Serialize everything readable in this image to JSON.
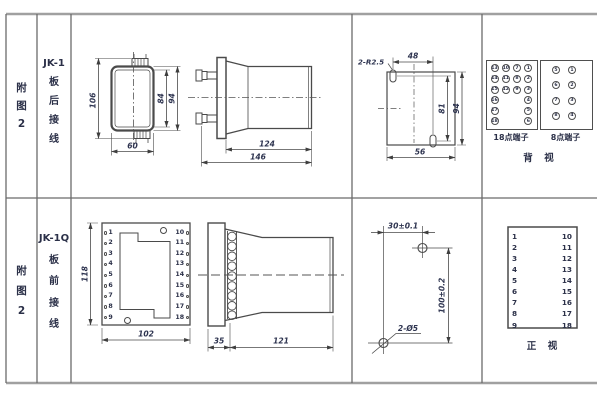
{
  "colors": {
    "frame_outer": "#a0a0a0",
    "grid_line": "#6b6b6b",
    "draw_line": "#4a4a4a",
    "text": "#2e3450"
  },
  "rows": [
    {
      "fig": [
        "附",
        "图",
        "2"
      ],
      "model": "JK-1",
      "wiring": [
        "板",
        "后",
        "接",
        "线"
      ]
    },
    {
      "fig": [
        "附",
        "图",
        "2"
      ],
      "model": "JK-1Q",
      "wiring": [
        "板",
        "前",
        "接",
        "线"
      ]
    }
  ],
  "rear_case": {
    "height": "106",
    "inner": "84",
    "outer": "94",
    "width": "60"
  },
  "rear_side": {
    "body": "124",
    "total": "146"
  },
  "cutout": {
    "slots": "2-R2.5",
    "top": "48",
    "inner": "81",
    "outer": "94",
    "bottom": "56"
  },
  "rear_terminals": {
    "t18": {
      "label": "18点端子",
      "cols": [
        [
          13,
          14,
          15,
          16,
          17,
          18
        ],
        [
          10,
          11,
          12
        ],
        [
          7,
          8,
          9
        ],
        [
          1,
          2,
          3,
          4,
          5,
          6
        ]
      ]
    },
    "t8": {
      "label": "8点端子",
      "cols": [
        [
          5,
          6,
          7,
          8
        ],
        [
          1,
          2,
          3,
          4
        ]
      ]
    },
    "view": "背　视"
  },
  "front_panel": {
    "height": "118",
    "width": "102",
    "left": [
      1,
      2,
      3,
      4,
      5,
      6,
      7,
      8,
      9
    ],
    "right": [
      10,
      11,
      12,
      13,
      14,
      15,
      16,
      17,
      18
    ]
  },
  "front_side": {
    "plate": "35",
    "body": "121"
  },
  "drill": {
    "h": "30±0.1",
    "v": "100±0.2",
    "holes": "2-Ø5"
  },
  "front_table": {
    "left": [
      1,
      2,
      3,
      4,
      5,
      6,
      7,
      8,
      9
    ],
    "right": [
      10,
      11,
      12,
      13,
      14,
      15,
      16,
      17,
      18
    ],
    "view": "正　视"
  }
}
